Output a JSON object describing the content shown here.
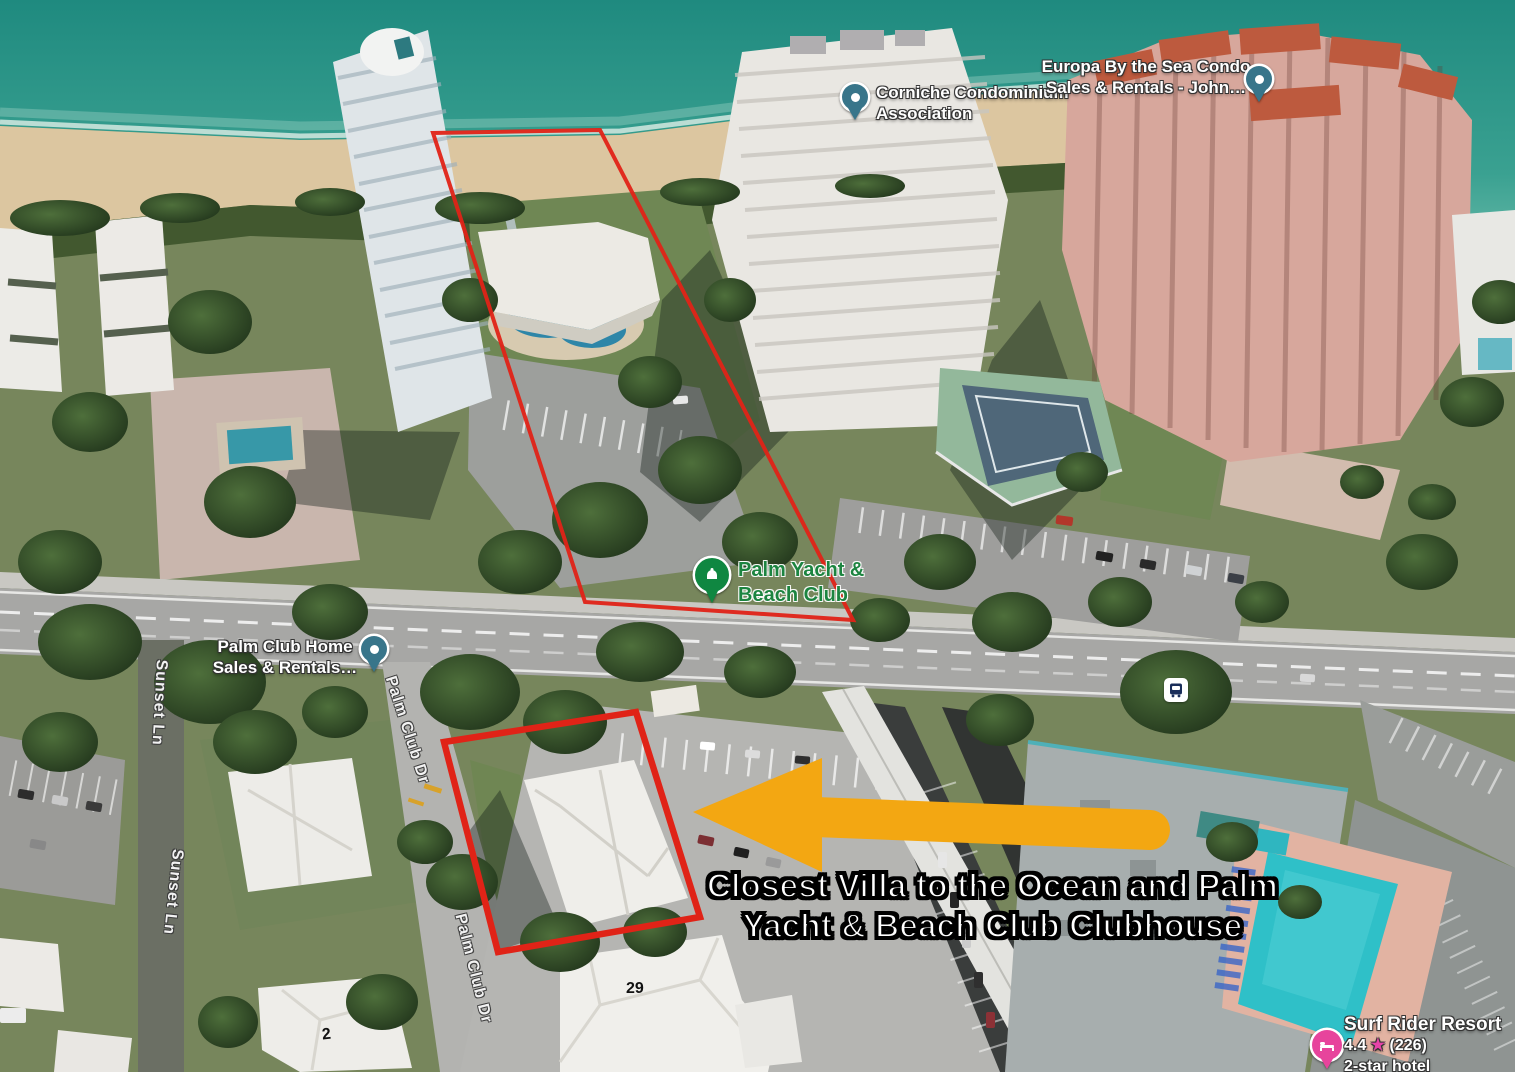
{
  "map_labels": {
    "corniche": {
      "line1": "Corniche Condominium",
      "line2": "Association"
    },
    "europa": {
      "line1": "Europa By the Sea Condo",
      "line2": "Sales & Rentals - John…"
    },
    "palm_club_home": {
      "line1": "Palm Club Home",
      "line2": "Sales & Rentals…"
    },
    "palm_yacht": {
      "line1": "Palm Yacht &",
      "line2": "Beach Club"
    },
    "surf_rider": {
      "name": "Surf Rider Resort",
      "rating": "4.4",
      "star": "★",
      "reviews": "(226)",
      "category": "2-star hotel"
    }
  },
  "street_labels": {
    "sunset_ln_upper": "Sunset Ln",
    "sunset_ln_lower": "Sunset Ln",
    "palm_club_dr_upper": "Palm Club Dr",
    "palm_club_dr_lower": "Palm Club Dr"
  },
  "building_numbers": {
    "villa_29": "29",
    "villa_2": "2"
  },
  "annotation": {
    "caption_line1": "Closest Villa to the Ocean and Palm",
    "caption_line2": "Yacht & Beach Club Clubhouse"
  },
  "colors": {
    "annotation_arrow": "#F3A712",
    "parcel_outline": "#E02317",
    "poi_green": "#1C8440",
    "pin_teal": "#38758A",
    "pin_pink": "#E7449C",
    "ocean": "#2F988B",
    "beach": "#DCC6A0"
  }
}
